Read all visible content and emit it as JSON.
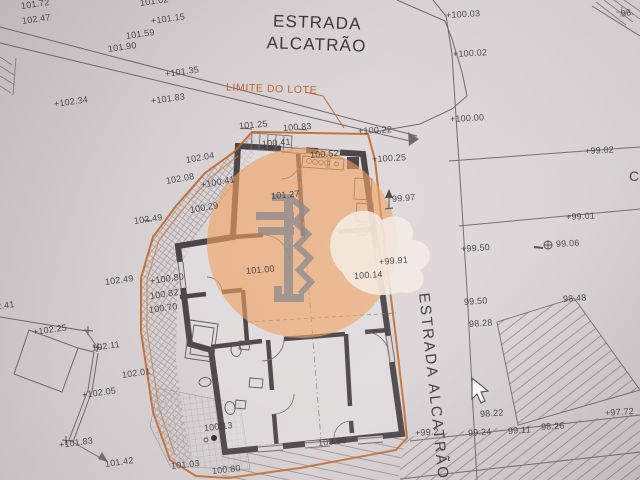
{
  "street_top": {
    "line1": "ESTRADA",
    "line2": "ALCATRÃO"
  },
  "street_right": "ESTRADA ALCATRÃO",
  "lot_limit_label": "LIMITE DO LOTE",
  "icons": {
    "cursor": "mouse-pointer-arrow",
    "survey_marker": "circle-plus",
    "watermark": "anchor-in-orange-circle"
  },
  "colors": {
    "boundary_orange": "#c2692f",
    "label_orange": "#c0622c",
    "watermark_orange": "#efa261",
    "ink": "#5a5558",
    "wall": "#4b4547",
    "paper": "#d9d3d5",
    "text": "#413d40"
  },
  "levels": [
    {
      "t": "101.72",
      "x": 21,
      "y": 1,
      "r": -8
    },
    {
      "t": "102.47",
      "x": 22,
      "y": 16,
      "r": -8
    },
    {
      "t": "101.02",
      "x": 140,
      "y": -2,
      "r": -8
    },
    {
      "t": "+101.15",
      "x": 151,
      "y": 16,
      "r": -8
    },
    {
      "t": "101.59",
      "x": 126,
      "y": 31,
      "r": -8
    },
    {
      "t": "101.90",
      "x": 108,
      "y": 44,
      "r": -8
    },
    {
      "t": "+101.35",
      "x": 165,
      "y": 69,
      "r": -8
    },
    {
      "t": "+101.83",
      "x": 151,
      "y": 96,
      "r": -8
    },
    {
      "t": "+102.34",
      "x": 54,
      "y": 99,
      "r": -8
    },
    {
      "t": "102.04",
      "x": 186,
      "y": 155,
      "r": -10
    },
    {
      "t": "102.08",
      "x": 166,
      "y": 176,
      "r": -10
    },
    {
      "t": "+100.41",
      "x": 201,
      "y": 180,
      "r": -10
    },
    {
      "t": "100.29",
      "x": 190,
      "y": 205,
      "r": -10
    },
    {
      "t": "102.49",
      "x": 134,
      "y": 216,
      "r": -8
    },
    {
      "t": "102.49",
      "x": 105,
      "y": 277,
      "r": -8
    },
    {
      "t": "+100.80",
      "x": 150,
      "y": 276,
      "r": -8
    },
    {
      "t": "100.82",
      "x": 150,
      "y": 291,
      "r": -8
    },
    {
      "t": "100.70",
      "x": 149,
      "y": 305,
      "r": -8
    },
    {
      "t": "102.41",
      "x": -14,
      "y": 303,
      "r": -8
    },
    {
      "t": "+102.25",
      "x": 33,
      "y": 327,
      "r": -8
    },
    {
      "t": "102.11",
      "x": 92,
      "y": 343,
      "r": -8
    },
    {
      "t": "102.01",
      "x": 122,
      "y": 370,
      "r": -8
    },
    {
      "t": "+102.05",
      "x": 82,
      "y": 390,
      "r": -8
    },
    {
      "t": "+101.83",
      "x": 59,
      "y": 440,
      "r": -8
    },
    {
      "t": "101.42",
      "x": 105,
      "y": 459,
      "r": -8
    },
    {
      "t": "101.25",
      "x": 239,
      "y": 121,
      "r": -5
    },
    {
      "t": "100.83",
      "x": 283,
      "y": 123,
      "r": -4
    },
    {
      "t": "+100.22",
      "x": 358,
      "y": 126,
      "r": -3
    },
    {
      "t": "100.41",
      "x": 262,
      "y": 139,
      "r": -5
    },
    {
      "t": "100.52",
      "x": 310,
      "y": 150,
      "r": -4
    },
    {
      "t": "+100.25",
      "x": 372,
      "y": 154,
      "r": -3
    },
    {
      "t": "101.27",
      "x": 271,
      "y": 191,
      "r": -5
    },
    {
      "t": "101.00",
      "x": 246,
      "y": 266,
      "r": -5
    },
    {
      "t": "100.14",
      "x": 354,
      "y": 271,
      "r": -4
    },
    {
      "t": "100.13",
      "x": 204,
      "y": 423,
      "r": -6
    },
    {
      "t": "101.03",
      "x": 171,
      "y": 461,
      "r": -6
    },
    {
      "t": "100.80",
      "x": 212,
      "y": 466,
      "r": -6
    },
    {
      "t": "100.80",
      "x": 318,
      "y": 438,
      "r": -6
    },
    {
      "t": "+100.03",
      "x": 446,
      "y": 10,
      "r": -3
    },
    {
      "t": "+100.02",
      "x": 453,
      "y": 49,
      "r": -3
    },
    {
      "t": "+100.00",
      "x": 450,
      "y": 114,
      "r": -3
    },
    {
      "t": "+99.02",
      "x": 585,
      "y": 146,
      "r": -3
    },
    {
      "t": "+99.01",
      "x": 566,
      "y": 212,
      "r": -3
    },
    {
      "t": "99.06",
      "x": 556,
      "y": 239,
      "r": -3
    },
    {
      "t": "+99.50",
      "x": 461,
      "y": 244,
      "r": -4
    },
    {
      "t": "99.97",
      "x": 392,
      "y": 194,
      "r": -5
    },
    {
      "t": "+99.91",
      "x": 379,
      "y": 257,
      "r": -5
    },
    {
      "t": "99.50",
      "x": 464,
      "y": 297,
      "r": -4
    },
    {
      "t": "98.28",
      "x": 469,
      "y": 319,
      "r": -4
    },
    {
      "t": "98.48",
      "x": 563,
      "y": 294,
      "r": -4
    },
    {
      "t": "98.22",
      "x": 480,
      "y": 409,
      "r": -4
    },
    {
      "t": "99.24",
      "x": 468,
      "y": 428,
      "r": -4
    },
    {
      "t": "99.11",
      "x": 508,
      "y": 426,
      "r": -4
    },
    {
      "t": "98.26",
      "x": 541,
      "y": 422,
      "r": -4
    },
    {
      "t": "+97.72",
      "x": 605,
      "y": 408,
      "r": -4
    },
    {
      "t": "+99.2",
      "x": 415,
      "y": 428,
      "r": -4
    },
    {
      "t": "98.",
      "x": 621,
      "y": 9,
      "r": -12
    },
    {
      "t": "C",
      "x": 629,
      "y": 168,
      "r": 0,
      "fs": 14
    }
  ]
}
